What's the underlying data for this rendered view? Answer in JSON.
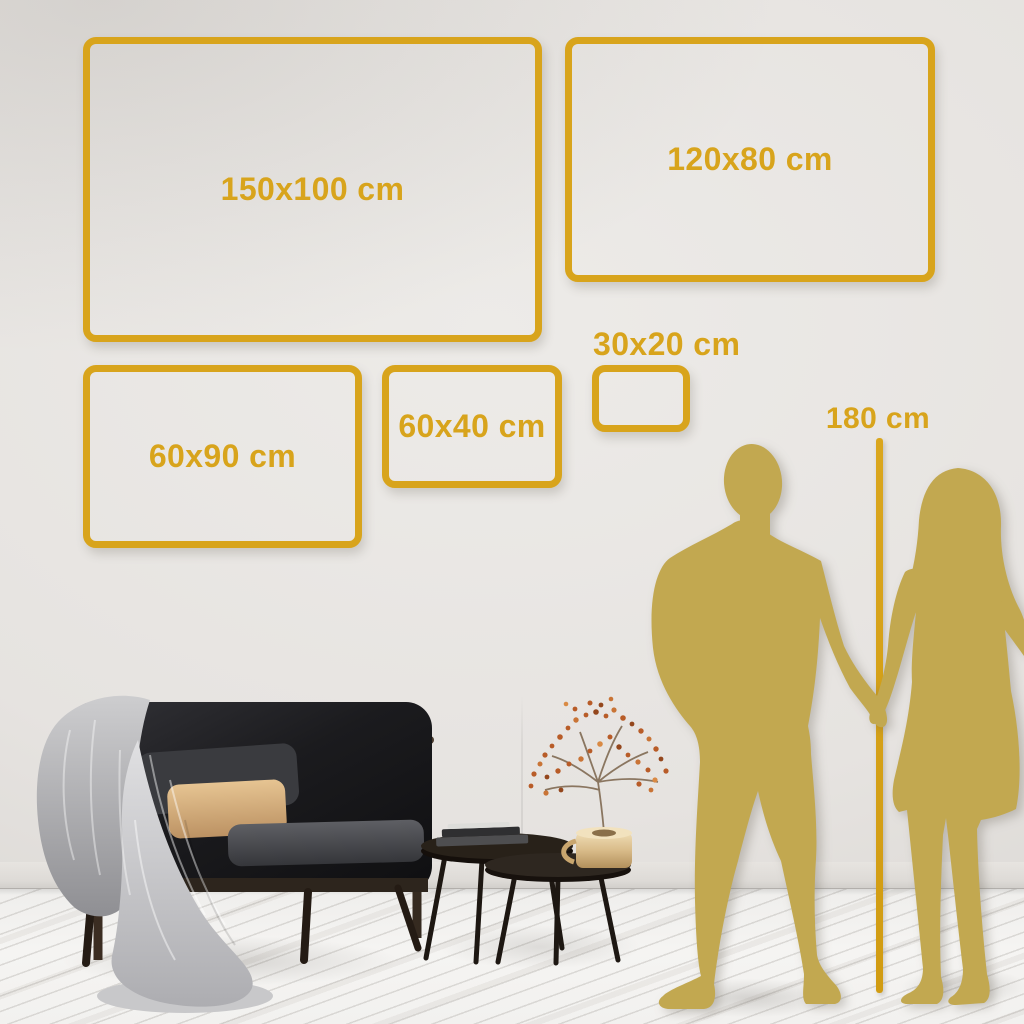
{
  "size_guide": {
    "unit": "cm",
    "frames": [
      {
        "id": "150x100",
        "label": "150x100 cm"
      },
      {
        "id": "120x80",
        "label": "120x80 cm"
      },
      {
        "id": "60x90",
        "label": "60x90 cm"
      },
      {
        "id": "60x40",
        "label": "60x40 cm"
      },
      {
        "id": "30x20",
        "label": "30x20 cm"
      }
    ],
    "height_reference": {
      "label": "180 cm"
    },
    "colors": {
      "accent_gold": "#D8A41C",
      "silhouette_gold": "#C2A850",
      "wall": "#E7E4E0",
      "floor": "#F4F3F1",
      "sofa_velvet": "#1A1A1D",
      "tan_pillow": "#D8B584",
      "blanket_gray": "#C6C6C8",
      "wood_dark": "#3B2D22",
      "brass_vase": "#DCC08C",
      "flower_rust": "#B85C28"
    }
  },
  "scene": {
    "silhouettes": [
      {
        "name": "man-silhouette"
      },
      {
        "name": "woman-silhouette"
      }
    ],
    "furniture": [
      {
        "name": "sofa-with-blanket"
      },
      {
        "name": "nesting-coffee-tables"
      },
      {
        "name": "books-stack"
      },
      {
        "name": "brass-vase-with-flowers"
      }
    ]
  }
}
